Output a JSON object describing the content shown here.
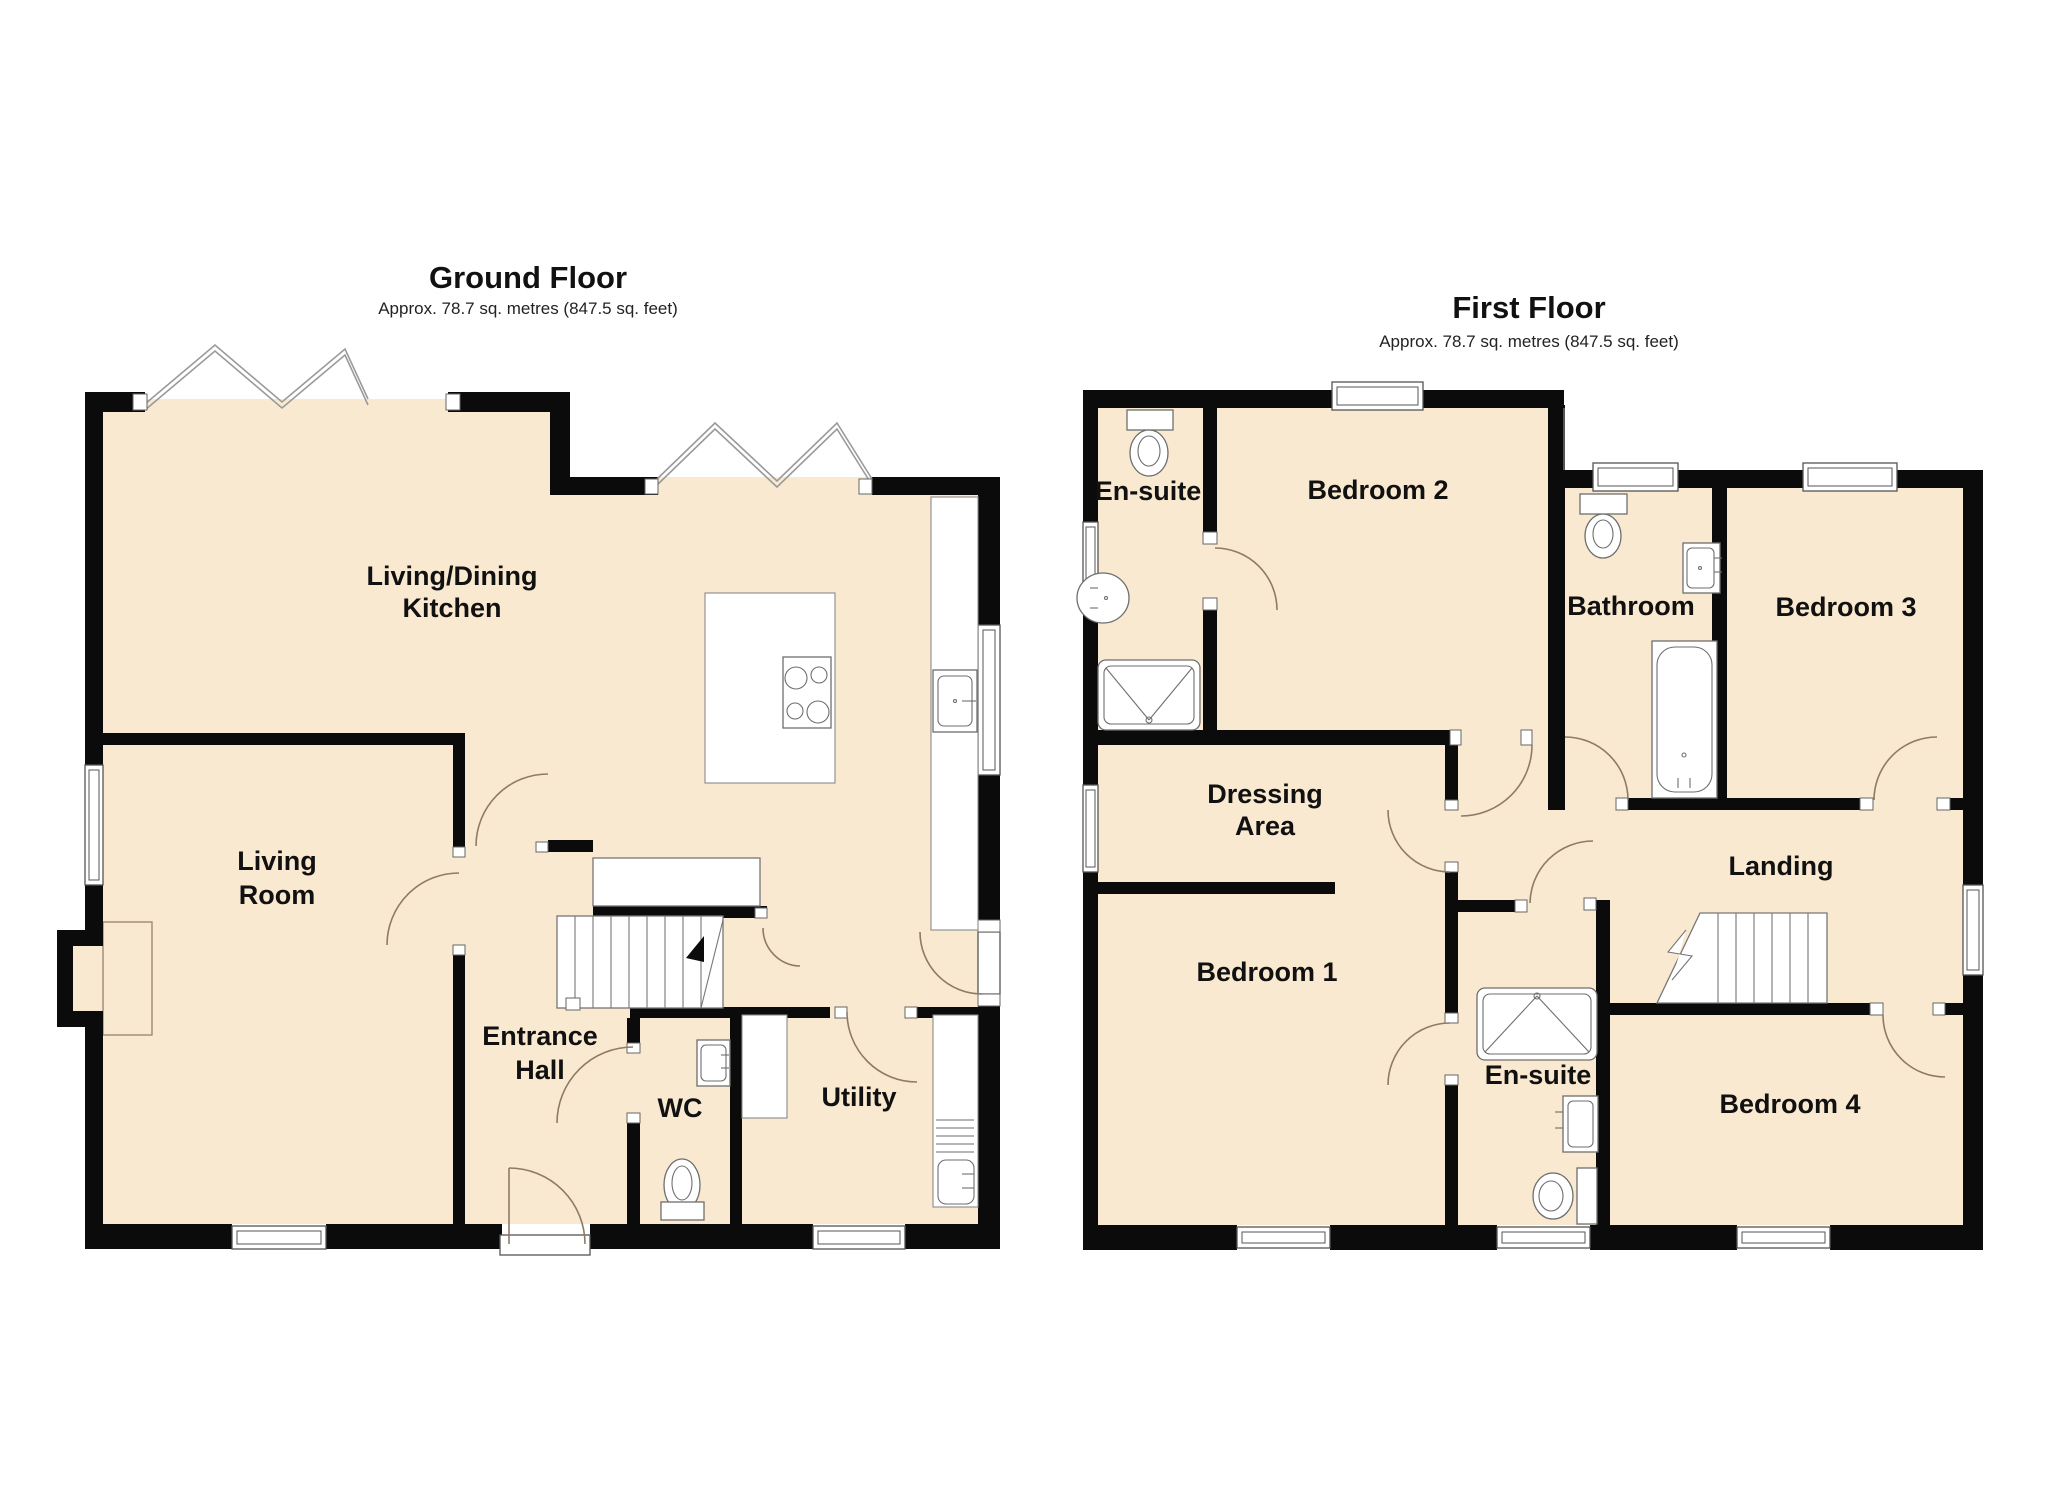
{
  "colors": {
    "floor_fill": "#F9E9D0",
    "wall": "#0b0b0b",
    "door_arc": "#8f7a66",
    "bay_window_line": "#9a9a9a"
  },
  "ground_floor": {
    "title": "Ground Floor",
    "subtitle": "Approx. 78.7 sq. metres (847.5 sq. feet)",
    "rooms": {
      "living_dining_kitchen": {
        "line1": "Living/Dining",
        "line2": "Kitchen"
      },
      "living_room": {
        "line1": "Living",
        "line2": "Room"
      },
      "entrance_hall": {
        "line1": "Entrance",
        "line2": "Hall"
      },
      "wc": {
        "label": "WC"
      },
      "utility": {
        "label": "Utility"
      }
    }
  },
  "first_floor": {
    "title": "First Floor",
    "subtitle": "Approx. 78.7 sq. metres (847.5 sq. feet)",
    "rooms": {
      "ensuite_top": {
        "label": "En-suite"
      },
      "bedroom2": {
        "label": "Bedroom 2"
      },
      "bathroom": {
        "label": "Bathroom"
      },
      "bedroom3": {
        "label": "Bedroom 3"
      },
      "dressing_area": {
        "line1": "Dressing",
        "line2": "Area"
      },
      "landing": {
        "label": "Landing"
      },
      "bedroom1": {
        "label": "Bedroom 1"
      },
      "ensuite_bottom": {
        "label": "En-suite"
      },
      "bedroom4": {
        "label": "Bedroom 4"
      }
    }
  }
}
